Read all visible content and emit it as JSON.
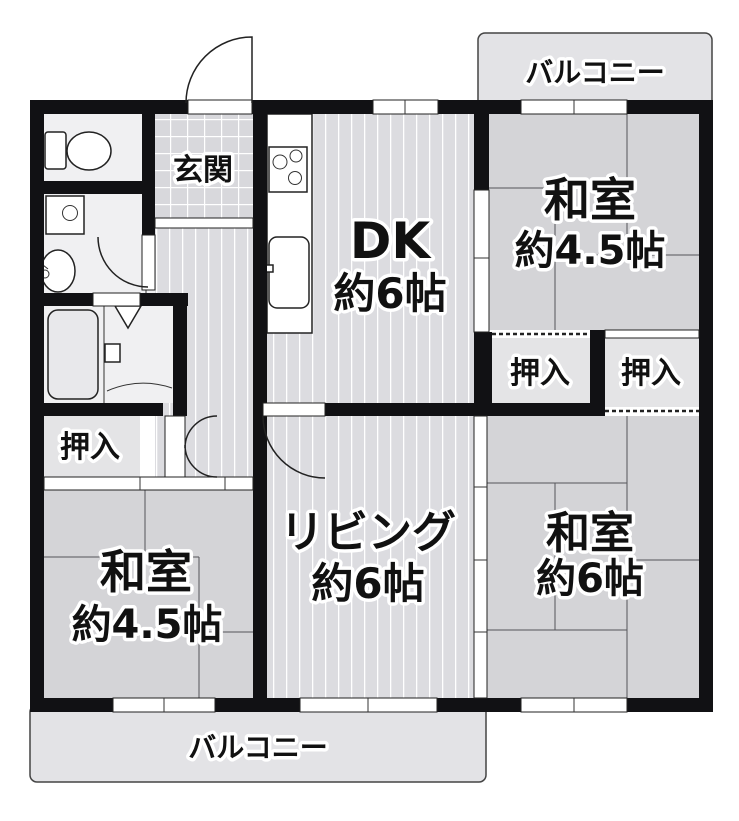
{
  "colors": {
    "wall": "#111114",
    "tatami": "#d4d4d7",
    "flooring": "#dcdce0",
    "tile": "#d8d8dc",
    "sanitary": "#f0f0f2",
    "closet": "#e4e4e6",
    "balcony": "#e3e3e6",
    "line": "#333333"
  },
  "rooms": {
    "balcony_top": {
      "label": "バルコニー"
    },
    "balcony_bottom": {
      "label": "バルコニー"
    },
    "genkan": {
      "label": "玄関"
    },
    "dk": {
      "name": "DK",
      "size": "約6帖"
    },
    "washitsu_ne": {
      "name": "和室",
      "size": "約4.5帖"
    },
    "washitsu_sw": {
      "name": "和室",
      "size": "約4.5帖"
    },
    "washitsu_se": {
      "name": "和室",
      "size": "約6帖"
    },
    "living": {
      "name": "リビング",
      "size": "約6帖"
    },
    "closet_mid_left": {
      "label": "押入"
    },
    "closet_mid_right": {
      "label": "押入"
    },
    "closet_west": {
      "label": "押入"
    }
  }
}
